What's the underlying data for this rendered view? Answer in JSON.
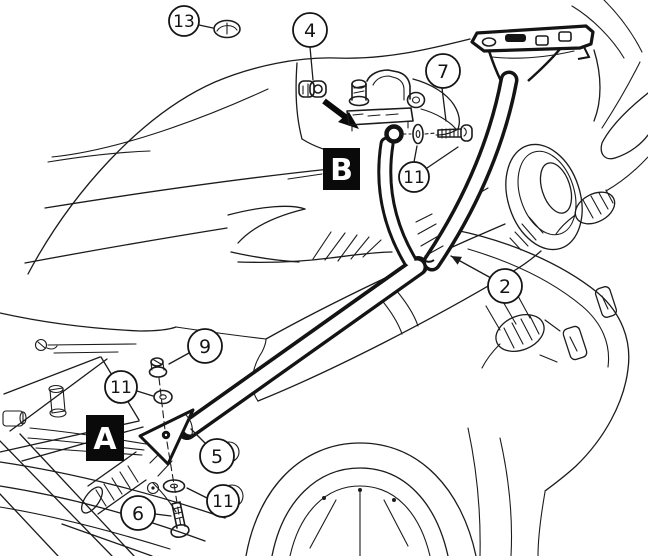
{
  "colors": {
    "ink": "#1b1b1b",
    "paper": "#ffffff",
    "marker_bg": "#0a0a0a",
    "marker_fg": "#ffffff"
  },
  "diagram": {
    "callouts": [
      {
        "id": "callout-13",
        "label": "13",
        "cx": 184,
        "cy": 21,
        "r": 15,
        "leaders": [
          {
            "x1": 199,
            "y1": 25,
            "x2": 213,
            "y2": 28
          }
        ]
      },
      {
        "id": "callout-4",
        "label": "4",
        "cx": 310,
        "cy": 30,
        "r": 17,
        "leaders": [
          {
            "x1": 310,
            "y1": 47,
            "x2": 313,
            "y2": 80
          }
        ]
      },
      {
        "id": "callout-7",
        "label": "7",
        "cx": 443,
        "cy": 71,
        "r": 17,
        "leaders": [
          {
            "x1": 442,
            "y1": 88,
            "x2": 446,
            "y2": 121
          }
        ]
      },
      {
        "id": "callout-11a",
        "label": "11",
        "cx": 414,
        "cy": 177,
        "r": 15,
        "leaders": [
          {
            "x1": 414,
            "y1": 162,
            "x2": 417,
            "y2": 146
          },
          {
            "x1": 427,
            "y1": 168,
            "x2": 458,
            "y2": 147
          }
        ]
      },
      {
        "id": "callout-2",
        "label": "2",
        "cx": 505,
        "cy": 286,
        "r": 17,
        "leaders": [
          {
            "x1": 491,
            "y1": 278,
            "x2": 451,
            "y2": 256,
            "arrow": true
          }
        ]
      },
      {
        "id": "callout-9",
        "label": "9",
        "cx": 205,
        "cy": 346,
        "r": 17,
        "leaders": [
          {
            "x1": 189,
            "y1": 353,
            "x2": 169,
            "y2": 364
          }
        ]
      },
      {
        "id": "callout-11b",
        "label": "11",
        "cx": 121,
        "cy": 387,
        "r": 16,
        "leaders": [
          {
            "x1": 137,
            "y1": 391,
            "x2": 153,
            "y2": 396
          }
        ]
      },
      {
        "id": "callout-5",
        "label": "5",
        "cx": 217,
        "cy": 456,
        "r": 17,
        "leaders": [
          {
            "x1": 206,
            "y1": 444,
            "x2": 191,
            "y2": 429
          }
        ]
      },
      {
        "id": "callout-11c",
        "label": "11",
        "cx": 223,
        "cy": 501,
        "r": 16,
        "leaders": [
          {
            "x1": 207,
            "y1": 498,
            "x2": 187,
            "y2": 488
          }
        ]
      },
      {
        "id": "callout-6",
        "label": "6",
        "cx": 138,
        "cy": 513,
        "r": 17,
        "leaders": [
          {
            "x1": 155,
            "y1": 514,
            "x2": 171,
            "y2": 516
          }
        ]
      }
    ],
    "markers": [
      {
        "id": "marker-a",
        "label": "A",
        "x": 86,
        "y": 415,
        "w": 38,
        "h": 46
      },
      {
        "id": "marker-b",
        "label": "B",
        "x": 323,
        "y": 148,
        "w": 37,
        "h": 42
      }
    ]
  }
}
